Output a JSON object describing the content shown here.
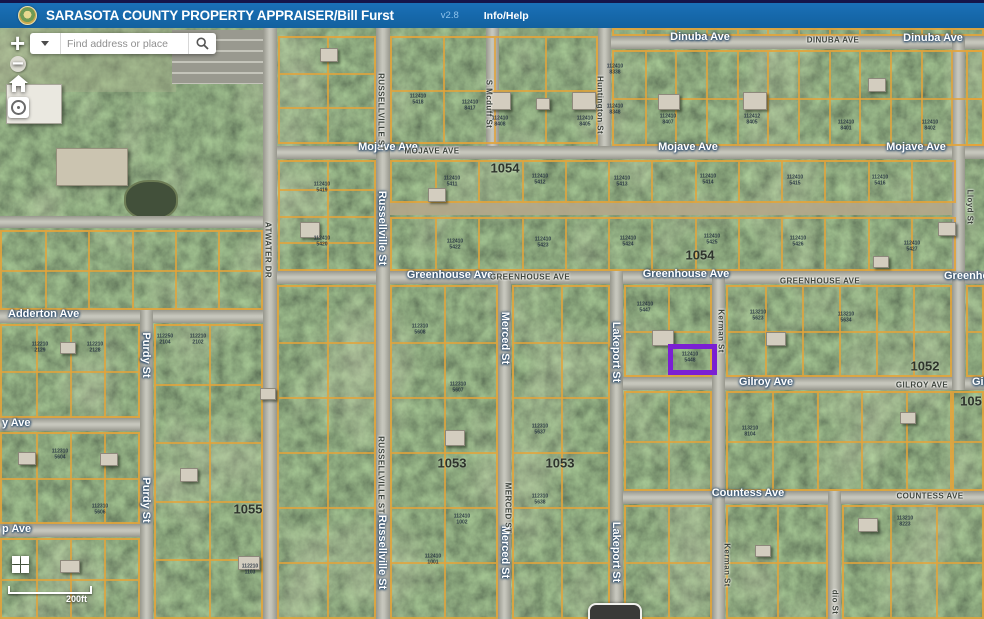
{
  "header": {
    "app_title": "SARASOTA COUNTY PROPERTY APPRAISER/Bill Furst",
    "version": "v2.8",
    "info_help": "Info/Help"
  },
  "search": {
    "placeholder": "Find address or place"
  },
  "controls": {
    "zoom_in": "+",
    "zoom_out": "−",
    "scale_label": "200ft"
  },
  "map": {
    "colors": {
      "parcel_line": "#E4A43A",
      "highlight": "#7B1FD3",
      "road": "#B5B5AB",
      "dirt": "#B3A78A"
    },
    "highlight": {
      "x": 668,
      "y": 316,
      "w": 49,
      "h": 31
    },
    "roads": [
      {
        "name": "Dinuba Ave",
        "o": "h",
        "x": 600,
        "y": 8,
        "len": 384,
        "w": 13
      },
      {
        "name": "Mojave Ave",
        "o": "h",
        "x": 268,
        "y": 118,
        "len": 716,
        "w": 13
      },
      {
        "name": "Greenhouse Ave",
        "o": "h",
        "x": 268,
        "y": 243,
        "len": 716,
        "w": 13
      },
      {
        "name": "Adderton Ave",
        "o": "h",
        "x": 0,
        "y": 282,
        "len": 272,
        "w": 13
      },
      {
        "name": "y Ave",
        "o": "h",
        "x": 0,
        "y": 390,
        "len": 152,
        "w": 13
      },
      {
        "name": "p Ave",
        "o": "h",
        "x": 0,
        "y": 496,
        "len": 152,
        "w": 13
      },
      {
        "name": "Gilroy Ave",
        "o": "h",
        "x": 614,
        "y": 349,
        "len": 370,
        "w": 13
      },
      {
        "name": "Countess Ave",
        "o": "h",
        "x": 614,
        "y": 463,
        "len": 370,
        "w": 13
      },
      {
        "name": "campus road",
        "o": "h",
        "x": 0,
        "y": 188,
        "len": 268,
        "w": 12
      },
      {
        "name": "dirt lane",
        "o": "h",
        "x": 388,
        "y": 175,
        "len": 570,
        "w": 12,
        "dirt": true
      },
      {
        "name": "Purdy St",
        "o": "v",
        "x": 140,
        "y": 282,
        "len": 309,
        "w": 13
      },
      {
        "name": "Atwater Dr",
        "o": "v",
        "x": 263,
        "y": 0,
        "len": 591,
        "w": 14
      },
      {
        "name": "Russellville St",
        "o": "v",
        "x": 376,
        "y": 0,
        "len": 591,
        "w": 14
      },
      {
        "name": "S Mcduff St",
        "o": "v",
        "x": 486,
        "y": 0,
        "len": 118,
        "w": 13
      },
      {
        "name": "Merced St",
        "o": "v",
        "x": 498,
        "y": 243,
        "len": 348,
        "w": 13
      },
      {
        "name": "Huntington St",
        "o": "v",
        "x": 598,
        "y": 0,
        "len": 118,
        "w": 13
      },
      {
        "name": "Lakeport St",
        "o": "v",
        "x": 610,
        "y": 243,
        "len": 348,
        "w": 13
      },
      {
        "name": "Kerman St",
        "o": "v",
        "x": 712,
        "y": 243,
        "len": 348,
        "w": 13
      },
      {
        "name": "dio St",
        "o": "v",
        "x": 828,
        "y": 463,
        "len": 128,
        "w": 13
      },
      {
        "name": "Lloyd St",
        "o": "v",
        "x": 952,
        "y": 8,
        "len": 354,
        "w": 13
      }
    ],
    "blocks": [
      [
        278,
        8,
        98,
        108,
        2,
        3
      ],
      [
        390,
        8,
        208,
        108,
        4,
        2
      ],
      [
        612,
        22,
        372,
        96,
        12,
        2
      ],
      [
        612,
        0,
        372,
        8,
        12,
        1
      ],
      [
        966,
        22,
        18,
        96,
        1,
        2
      ],
      [
        278,
        132,
        98,
        111,
        2,
        4
      ],
      [
        390,
        132,
        566,
        43,
        13,
        1
      ],
      [
        390,
        189,
        566,
        54,
        13,
        1
      ],
      [
        624,
        257,
        88,
        92,
        2,
        2
      ],
      [
        726,
        257,
        226,
        92,
        6,
        2
      ],
      [
        966,
        257,
        18,
        92,
        1,
        2
      ],
      [
        624,
        363,
        88,
        100,
        2,
        2
      ],
      [
        726,
        363,
        226,
        100,
        5,
        2
      ],
      [
        952,
        363,
        32,
        100,
        1,
        2
      ],
      [
        624,
        477,
        88,
        114,
        2,
        2
      ],
      [
        726,
        477,
        102,
        114,
        2,
        2
      ],
      [
        842,
        477,
        142,
        114,
        3,
        2
      ],
      [
        512,
        257,
        98,
        334,
        2,
        6
      ],
      [
        390,
        257,
        108,
        334,
        2,
        6
      ],
      [
        277,
        257,
        99,
        334,
        2,
        6
      ],
      [
        154,
        296,
        109,
        295,
        2,
        5
      ],
      [
        0,
        296,
        140,
        94,
        4,
        2
      ],
      [
        0,
        404,
        140,
        92,
        4,
        2
      ],
      [
        0,
        510,
        140,
        81,
        4,
        2
      ],
      [
        0,
        202,
        263,
        80,
        6,
        2
      ]
    ],
    "street_labels": [
      {
        "t": "Dinuba Ave",
        "x": 700,
        "y": 9,
        "s": "app"
      },
      {
        "t": "Dinuba Ave",
        "x": 933,
        "y": 10,
        "s": "app"
      },
      {
        "t": "DINUBA AVE",
        "x": 833,
        "y": 12,
        "s": "base"
      },
      {
        "t": "Mojave Ave",
        "x": 388,
        "y": 119,
        "s": "app"
      },
      {
        "t": "Mojave Ave",
        "x": 688,
        "y": 119,
        "s": "app"
      },
      {
        "t": "Mojave Ave",
        "x": 916,
        "y": 119,
        "s": "app"
      },
      {
        "t": "MOJAVE AVE",
        "x": 432,
        "y": 123,
        "s": "base"
      },
      {
        "t": "Greenhouse Ave",
        "x": 450,
        "y": 247,
        "s": "app"
      },
      {
        "t": "Greenhouse Ave",
        "x": 686,
        "y": 246,
        "s": "app"
      },
      {
        "t": "Greenhouse",
        "x": 944,
        "y": 248,
        "s": "app",
        "a": "l"
      },
      {
        "t": "GREENHOUSE AVE",
        "x": 530,
        "y": 249,
        "s": "base"
      },
      {
        "t": "GREENHOUSE AVE",
        "x": 820,
        "y": 253,
        "s": "base"
      },
      {
        "t": "Adderton Ave",
        "x": 8,
        "y": 286,
        "s": "app",
        "a": "l"
      },
      {
        "t": "y Ave",
        "x": 2,
        "y": 395,
        "s": "app",
        "a": "l"
      },
      {
        "t": "p Ave",
        "x": 2,
        "y": 501,
        "s": "app",
        "a": "l"
      },
      {
        "t": "Gilroy Ave",
        "x": 766,
        "y": 354,
        "s": "app"
      },
      {
        "t": "Gil",
        "x": 972,
        "y": 354,
        "s": "app",
        "a": "l"
      },
      {
        "t": "GILROY AVE",
        "x": 922,
        "y": 357,
        "s": "base"
      },
      {
        "t": "Countess Ave",
        "x": 748,
        "y": 465,
        "s": "app"
      },
      {
        "t": "COUNTESS AVE",
        "x": 930,
        "y": 468,
        "s": "base"
      },
      {
        "t": "Purdy St",
        "x": 146,
        "y": 327,
        "s": "app",
        "r": 90
      },
      {
        "t": "Purdy St",
        "x": 146,
        "y": 472,
        "s": "app",
        "r": 90
      },
      {
        "t": "Russellville St",
        "x": 382,
        "y": 200,
        "s": "app",
        "r": 90
      },
      {
        "t": "Russellville St",
        "x": 382,
        "y": 524,
        "s": "app",
        "r": 90
      },
      {
        "t": "RUSSELLVILLE ST",
        "x": 381,
        "y": 84,
        "s": "base",
        "r": 90
      },
      {
        "t": "RUSSELLVILLE ST",
        "x": 381,
        "y": 447,
        "s": "base",
        "r": 90
      },
      {
        "t": "Merced St",
        "x": 505,
        "y": 310,
        "s": "app",
        "r": 90
      },
      {
        "t": "Merced St",
        "x": 505,
        "y": 524,
        "s": "app",
        "r": 90
      },
      {
        "t": "MERCED ST",
        "x": 508,
        "y": 480,
        "s": "base",
        "r": 90
      },
      {
        "t": "Lakeport St",
        "x": 616,
        "y": 324,
        "s": "app",
        "r": 90
      },
      {
        "t": "Lakeport St",
        "x": 616,
        "y": 524,
        "s": "app",
        "r": 90
      },
      {
        "t": "S Mcduff St",
        "x": 489,
        "y": 76,
        "s": "base",
        "r": 90
      },
      {
        "t": "Huntington St",
        "x": 600,
        "y": 77,
        "s": "base",
        "r": 90
      },
      {
        "t": "Lloyd St",
        "x": 970,
        "y": 179,
        "s": "base",
        "r": 90
      },
      {
        "t": "Kerman St",
        "x": 721,
        "y": 303,
        "s": "base",
        "r": 90
      },
      {
        "t": "Kerman St",
        "x": 727,
        "y": 537,
        "s": "base",
        "r": 90
      },
      {
        "t": "ATWATER DR",
        "x": 268,
        "y": 222,
        "s": "base",
        "r": 90
      },
      {
        "t": "dio St",
        "x": 835,
        "y": 574,
        "s": "base",
        "r": 90
      }
    ],
    "section_numbers": [
      [
        "1054",
        505,
        140
      ],
      [
        "1054",
        700,
        227
      ],
      [
        "1052",
        925,
        338
      ],
      [
        "105",
        971,
        373
      ],
      [
        "1053",
        452,
        435
      ],
      [
        "1053",
        560,
        435
      ],
      [
        "1055",
        248,
        481
      ]
    ],
    "parcel_numbers": [
      [
        500,
        94,
        "112410\n8408"
      ],
      [
        585,
        94,
        "112410\n8405"
      ],
      [
        668,
        92,
        "112410\n8407"
      ],
      [
        752,
        92,
        "112412\n8405"
      ],
      [
        846,
        98,
        "112410\n8401"
      ],
      [
        930,
        98,
        "112410\n8402"
      ],
      [
        418,
        72,
        "112410\n5418"
      ],
      [
        470,
        78,
        "112410\n8417"
      ],
      [
        322,
        160,
        "112410\n5419"
      ],
      [
        322,
        214,
        "112410\n5420"
      ],
      [
        452,
        154,
        "112410\n5411"
      ],
      [
        540,
        152,
        "112410\n5412"
      ],
      [
        622,
        154,
        "112410\n5413"
      ],
      [
        708,
        152,
        "112410\n5414"
      ],
      [
        795,
        153,
        "112410\n5415"
      ],
      [
        880,
        153,
        "112410\n5416"
      ],
      [
        455,
        217,
        "112410\n5422"
      ],
      [
        543,
        215,
        "112410\n5423"
      ],
      [
        628,
        214,
        "112410\n5424"
      ],
      [
        712,
        212,
        "112410\n5425"
      ],
      [
        798,
        214,
        "112410\n5426"
      ],
      [
        912,
        219,
        "112410\n5427"
      ],
      [
        645,
        280,
        "112410\n5447"
      ],
      [
        690,
        330,
        "112410\n5448"
      ],
      [
        758,
        288,
        "113210\n5623"
      ],
      [
        846,
        290,
        "113210\n5634"
      ],
      [
        420,
        302,
        "112310\n5608"
      ],
      [
        458,
        360,
        "112310\n5607"
      ],
      [
        165,
        312,
        "112250\n2104"
      ],
      [
        198,
        312,
        "112210\n2102"
      ],
      [
        95,
        320,
        "112210\n2128"
      ],
      [
        40,
        320,
        "112210\n2129"
      ],
      [
        750,
        404,
        "113210\n8104"
      ],
      [
        905,
        494,
        "113210\n8223"
      ],
      [
        540,
        402,
        "112310\n5637"
      ],
      [
        540,
        472,
        "112310\n5638"
      ],
      [
        615,
        82,
        "112410\n8348"
      ],
      [
        615,
        42,
        "112410\n8338"
      ],
      [
        250,
        542,
        "112210\n1103"
      ],
      [
        60,
        427,
        "112310\n5604"
      ],
      [
        100,
        482,
        "112310\n5606"
      ],
      [
        433,
        532,
        "112410\n1001"
      ],
      [
        462,
        492,
        "112410\n1002"
      ]
    ],
    "buildings": [
      [
        487,
        64,
        22,
        16
      ],
      [
        572,
        64,
        22,
        16
      ],
      [
        658,
        66,
        20,
        14
      ],
      [
        743,
        64,
        22,
        16
      ],
      [
        868,
        50,
        16,
        12
      ],
      [
        300,
        194,
        18,
        14
      ],
      [
        428,
        160,
        16,
        12
      ],
      [
        938,
        194,
        16,
        12
      ],
      [
        652,
        302,
        20,
        14
      ],
      [
        766,
        304,
        18,
        12
      ],
      [
        900,
        384,
        14,
        10
      ],
      [
        858,
        490,
        18,
        12
      ],
      [
        445,
        402,
        18,
        14
      ],
      [
        238,
        528,
        20,
        12
      ],
      [
        320,
        20,
        16,
        12
      ],
      [
        536,
        70,
        12,
        10
      ],
      [
        60,
        314,
        14,
        10
      ],
      [
        100,
        425,
        16,
        11
      ],
      [
        180,
        440,
        16,
        12
      ],
      [
        260,
        360,
        14,
        10
      ],
      [
        755,
        517,
        14,
        10
      ],
      [
        873,
        228,
        14,
        10
      ],
      [
        60,
        532,
        18,
        11
      ],
      [
        18,
        424,
        16,
        11
      ]
    ]
  }
}
